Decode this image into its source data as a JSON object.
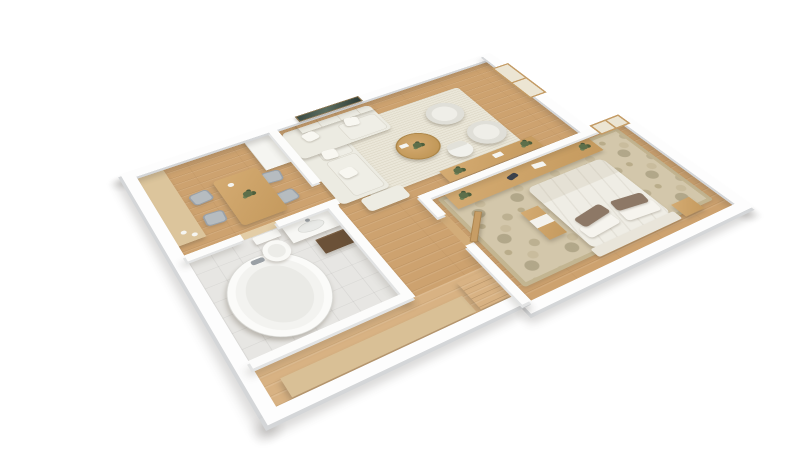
{
  "scene": {
    "type": "3d-floor-plan-render",
    "description": "Top-down 3D rendering of a one-bedroom apartment with white walls and oak flooring",
    "background_color": "#ffffff",
    "palette": {
      "wood_floor": "#cda26f",
      "hallway_floor": "#d8b283",
      "bathroom_tile": "#e7e6e3",
      "wall_top": "#fdfdfd",
      "wall_side": "#d4d6d8",
      "living_rug": "#eae6d8",
      "bedroom_rug": "#d3c7ab",
      "furniture_wood": "#cba26a",
      "upholstery_cream": "#edece3",
      "chair_gray": "#b6bcc0",
      "plant_green": "#5d6f4a",
      "pillow_brown": "#8d7866",
      "bath_shelf_dark": "#6b5138",
      "window_frame": "#c49c66",
      "wall_art_dark": "#3a4a44"
    },
    "rooms": [
      {
        "name": "kitchen-dining",
        "floor": "wood",
        "furniture": [
          "kitchen-counter",
          "refrigerator-cabinet",
          "dining-table",
          "dining-chairs-x4",
          "centerpiece-plant",
          "white-cup"
        ]
      },
      {
        "name": "living-room",
        "floor": "wood",
        "furniture": [
          "corner-sofa",
          "sofa-pillows",
          "ottoman",
          "area-rug",
          "round-coffee-table",
          "coffee-table-plant",
          "armchair-x2",
          "tv-console",
          "wall-art",
          "desk",
          "desk-chair",
          "desk-plants",
          "leaning-window"
        ]
      },
      {
        "name": "bathroom",
        "floor": "tile",
        "furniture": [
          "oval-bathtub",
          "toilet",
          "vanity-sink",
          "dark-wall-shelf"
        ]
      },
      {
        "name": "bedroom",
        "floor": "wood",
        "furniture": [
          "double-bed",
          "brown-pillows-x2",
          "white-pillows-x2",
          "damask-rug",
          "long-dresser",
          "dresser-plants",
          "game-controller",
          "nightstand",
          "bench",
          "leaning-window",
          "open-door"
        ]
      },
      {
        "name": "hallway",
        "floor": "wood-light",
        "furniture": [
          "long-sideboard",
          "drawer-cabinet"
        ]
      }
    ]
  }
}
